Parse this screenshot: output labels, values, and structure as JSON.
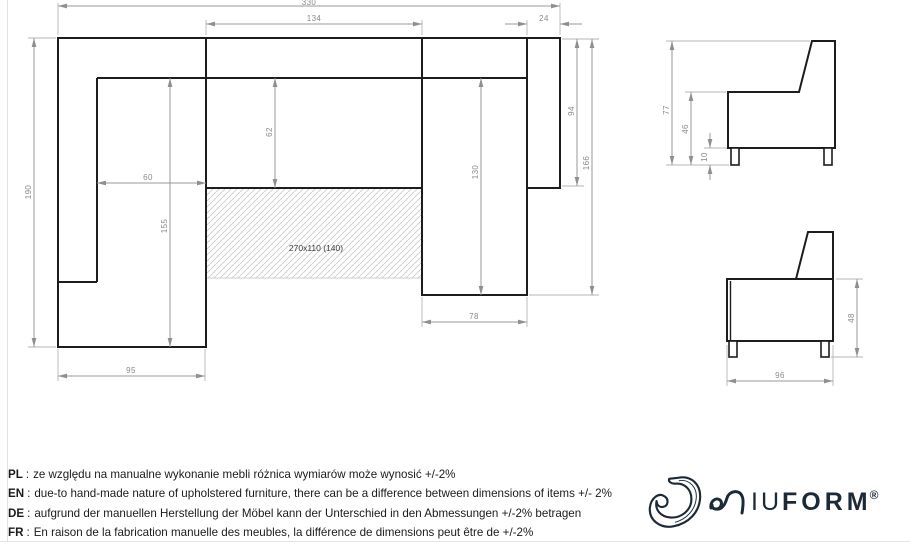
{
  "top_view": {
    "bed_area_label": "270x110 (140)",
    "dims": {
      "total_width": "330",
      "seat_width": "134",
      "corner_side": "24",
      "total_depth": "190",
      "left_seat_width": "60",
      "left_side_length": "155",
      "seat_depth": "62",
      "right_seat_length": "130",
      "right_side_upper": "94",
      "right_side_length": "166",
      "right_seat_width": "78",
      "left_side_width": "95"
    }
  },
  "side_views": {
    "back_profile": {
      "total_height": "77",
      "seat_height": "46",
      "leg_height": "10"
    },
    "arm_profile": {
      "side_height": "48",
      "depth": "96"
    }
  },
  "footer": {
    "separator": ":",
    "notes": [
      {
        "lang": "PL",
        "text": "ze względu na manualne wykonanie mebli różnica wymiarów może wynosić +/-2%"
      },
      {
        "lang": "EN",
        "text": "due-to hand-made nature of upholstered furniture, there can be a difference between dimensions of items +/- 2%"
      },
      {
        "lang": "DE",
        "text": "aufgrund der manuellen Herstellung der Möbel kann der Unterschied in den Abmessungen +/-2% betragen"
      },
      {
        "lang": "FR",
        "text": "En raison de la fabrication manuelle des meubles, la différence de dimensions peut être de +/-2%"
      }
    ],
    "logo": {
      "thin_letters": "IU",
      "bold_letters": "FORM",
      "registered": "®"
    }
  },
  "colors": {
    "outline": "#1d1d1d",
    "dimension_lines": "#9a9a9a",
    "dimension_text": "#8a8a8a",
    "hatch": "#cccccc",
    "logo": "#1c2a38"
  }
}
